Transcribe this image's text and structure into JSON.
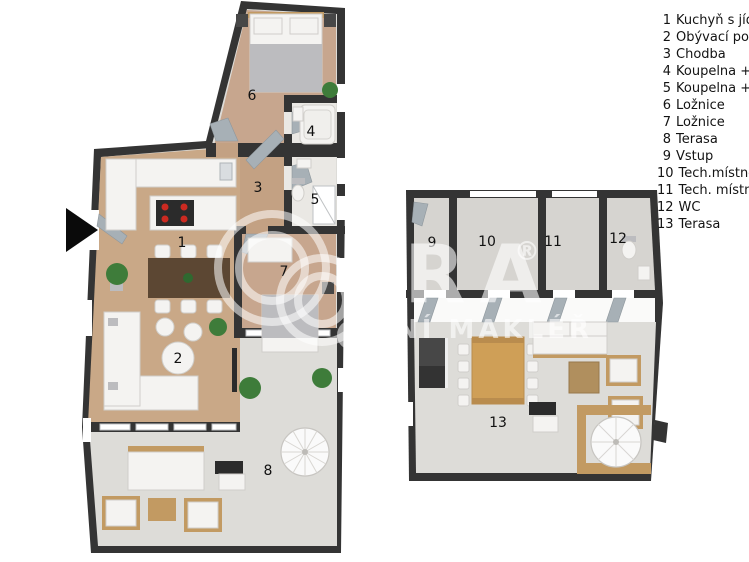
{
  "legend": {
    "items": [
      {
        "num": "1",
        "label": "Kuchyň s jíd"
      },
      {
        "num": "2",
        "label": "Obývací pok"
      },
      {
        "num": "3",
        "label": "Chodba"
      },
      {
        "num": "4",
        "label": "Koupelna +"
      },
      {
        "num": "5",
        "label": "Koupelna +"
      },
      {
        "num": "6",
        "label": "Ložnice"
      },
      {
        "num": "7",
        "label": "Ložnice"
      },
      {
        "num": "8",
        "label": "Terasa"
      },
      {
        "num": "9",
        "label": "Vstup"
      },
      {
        "num": "10",
        "label": "Tech.místno"
      },
      {
        "num": "11",
        "label": "Tech. místn"
      },
      {
        "num": "12",
        "label": "WC"
      },
      {
        "num": "13",
        "label": "Terasa"
      }
    ]
  },
  "rooms": {
    "n1": "1",
    "n2": "2",
    "n3": "3",
    "n4": "4",
    "n5": "5",
    "n6": "6",
    "n7": "7",
    "n8": "8",
    "n9": "9",
    "n10": "10",
    "n11": "11",
    "n12": "12",
    "n13": "13"
  },
  "watermark": {
    "brand": "RA",
    "registered": "®",
    "tagline": "NÍ MAKLÉŘ"
  },
  "colors": {
    "wall": "#343434",
    "wood_floor": "#c9a887",
    "bedroom_floor": "#c7a68e",
    "hall_floor": "#c3a183",
    "bathroom_floor": "#eae8e4",
    "terrace_floor": "#dddcd8",
    "concrete_floor": "#d6d4d0",
    "white_band": "#fafaf9",
    "furniture_wood": "#c29a62",
    "table_dark": "#5c4733",
    "upper_table_wood": "#cf9f57",
    "rug": "#b08f5e",
    "plant_green": "#3e7c3a",
    "hob_red": "#cc2a21",
    "door_gray": "#a7b0b6",
    "label": "#111111",
    "arrow_black": "#0a0a0a",
    "watermark_white": "rgba(255,255,255,0.58)"
  }
}
